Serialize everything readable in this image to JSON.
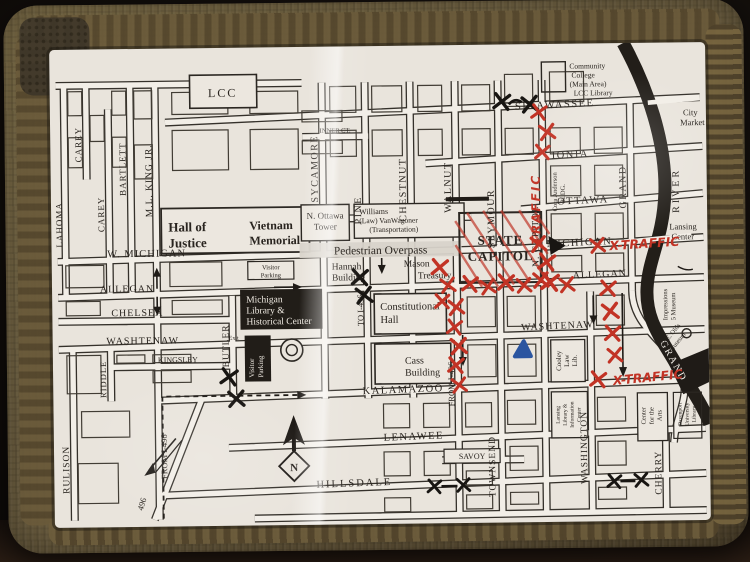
{
  "map": {
    "streets": {
      "shiawassee": "SHIAWASSEE",
      "inner_ct": "INNER CT.",
      "ionia": "IONIA",
      "ottawa": "OTTAWA",
      "w_michigan": "W. MICHIGAN",
      "michigan": "MICHIGAN",
      "allegan": "ALLEGAN",
      "chelsea": "CHELSEA",
      "washtenaw": "WASHTENAW",
      "kingsley": "KINGSLEY",
      "kalamazoo": "KALAMAZOO",
      "lenawee": "LENAWEE",
      "savoy": "SAVOY",
      "hillsdale": "HILLSDALE",
      "carey": "CAREY",
      "bartlett": "BARTLETT",
      "lahoma": "LAHOMA",
      "ml_king_jr": "M.L. KING JR.",
      "rulison": "RULISON",
      "riddle": "RIDDLE",
      "butler": "BUTLER",
      "sycamore": "SYCAMORE",
      "pine": "PINE",
      "chestnut": "CHESTNUT",
      "walnut": "WALNUT",
      "seymour": "SEYMOUR",
      "n_capitol": "N. CAPITOL",
      "grand": "GRAND",
      "townsend": "TOWNSEND",
      "washington": "WASHINGTON",
      "cherry": "CHERRY",
      "to_i496": "TO I-496",
      "from_i496": "FROM I-496",
      "i496": "496"
    },
    "river": {
      "grand": "GRAND",
      "river": "RIVER"
    },
    "places": {
      "lcc": "LCC",
      "lcc_college": {
        "l1": "Community",
        "l2": "College",
        "l3": "(Main Area)",
        "l4": "LCC Library"
      },
      "city_market": {
        "l1": "City",
        "l2": "Market"
      },
      "hall_of_justice": {
        "l1": "Hall of",
        "l2": "Justice"
      },
      "vietnam_memorial": {
        "l1": "Vietnam",
        "l2": "Memorial"
      },
      "visitor_parking": {
        "l1": "Visitor",
        "l2": "Parking"
      },
      "exit": "Exit",
      "n_ottawa_tower": {
        "l1": "N. Ottawa",
        "l2": "Tower"
      },
      "williams": {
        "l1": "Williams",
        "l2": "(Law)  VanWagoner",
        "l3": "(Transportation)"
      },
      "pedestrian_overpass": "Pedestrian Overpass",
      "hannah_building": {
        "l1": "Hannah",
        "l2": "Building"
      },
      "mason_treasury": {
        "l1": "Mason",
        "l2": "Treasury"
      },
      "state_capitol": {
        "l1": "STATE",
        "l2": "CAPITOL"
      },
      "cora_anderson": {
        "l1": "Cora Anderson",
        "l2": "BLDG."
      },
      "michigan_library": {
        "l1": "Michigan",
        "l2": "Library &",
        "l3": "Historical Center"
      },
      "constitutional_hall": {
        "l1": "Constitutional",
        "l2": "Hall"
      },
      "cass_building": {
        "l1": "Cass",
        "l2": "Building"
      },
      "cooley": {
        "l1": "Cooley",
        "l2": "Law",
        "l3": "Lib."
      },
      "lansing_library": {
        "l1": "Lansing",
        "l2": "Library &",
        "l3": "Information",
        "l4": "Center"
      },
      "center_for_arts": {
        "l1": "Center",
        "l2": "for the",
        "l3": "Arts"
      },
      "davenport": {
        "l1": "Davenport",
        "l2": "University",
        "l3": "Library"
      },
      "impressions": {
        "l1": "Impressions",
        "l2": "5 Museum"
      },
      "re_olds": {
        "l1": "R.E. Olds",
        "l2": "Museum"
      },
      "lansing_center": {
        "l1": "Lansing",
        "l2": "Center"
      },
      "compass": "N"
    },
    "annotations": {
      "traffic": "TRAFFIC",
      "x_traffic_michigan": "X-TRAFFIC",
      "x_traffic_south": "X-TRAFFIC"
    },
    "colors": {
      "marker_red": "#c23325",
      "marker_blue": "#2b55a0",
      "marker_black": "#181512",
      "capitol_hatch": "#d4747c",
      "paper": "#e8e3db",
      "ink": "#35312b",
      "case": "#6f6142"
    }
  }
}
